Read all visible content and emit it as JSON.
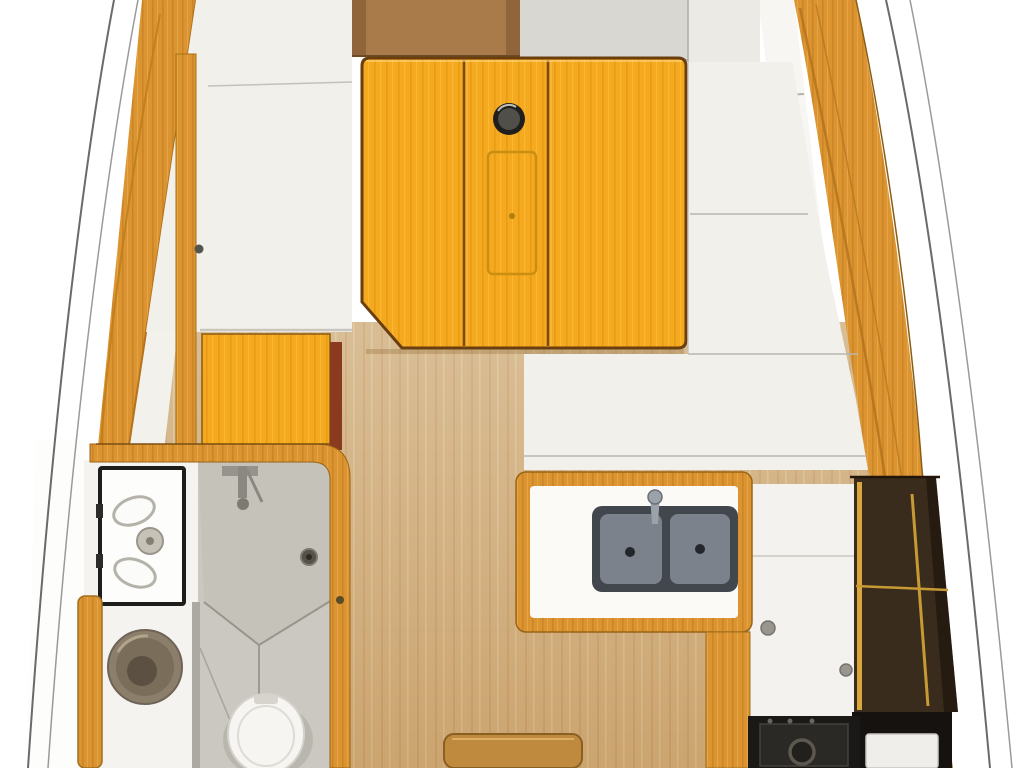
{
  "title": "sailboat-interior-floor-plan-top-view",
  "palette": {
    "hull_line": "#6a6a6a",
    "hull_line_light": "#9a9a9a",
    "trim": "#DB9430",
    "trim_dark": "#B4731C",
    "furniture": "#F4A91E",
    "furniture_grain": "#DE920E",
    "table_outline": "#6B3E0F",
    "floor": "#D2B181",
    "floor_grain": "#B98F55",
    "cushion": "#F1F0EB",
    "berth": "#D9D7D2",
    "liner": "#ECEAE5",
    "wall_white": "#F2F0EB",
    "shower": "#CBC8C1",
    "shower_tray": "#C5C2BA",
    "steel": "#7B828C",
    "steel_dark": "#42474E",
    "stove": "#1A1917",
    "shelf": "#3A2C1C",
    "shelf_rail": "#D9A73C",
    "toilet": "#F6F5F1",
    "toilet_shadow": "#B9B6AE",
    "basin": "#8B7E6B",
    "basin_deep": "#5C5042",
    "column": "#A97B4A",
    "maroon": "#8A3A1E",
    "vanity_border": "#1D1D1B",
    "step": "#C08A3E"
  },
  "areas": [
    {
      "id": "hull",
      "label": "hull outline"
    },
    {
      "id": "forward-cabin",
      "label": "forward cabin with mast column and berth"
    },
    {
      "id": "saloon-table",
      "label": "folding saloon table with bottle recess"
    },
    {
      "id": "port-settee",
      "label": "port settee"
    },
    {
      "id": "port-table",
      "label": "port side table"
    },
    {
      "id": "head",
      "label": "head (bathroom)"
    },
    {
      "id": "vanity",
      "label": "vanity washstand"
    },
    {
      "id": "round-basin",
      "label": "round washbasin"
    },
    {
      "id": "shower",
      "label": "shower tray with mixer and drain"
    },
    {
      "id": "toilet",
      "label": "toilet"
    },
    {
      "id": "cabin-sole",
      "label": "wood cabin sole / corridor"
    },
    {
      "id": "starboard-settee",
      "label": "starboard settee"
    },
    {
      "id": "galley",
      "label": "galley with double sink, lockers and stove"
    },
    {
      "id": "storage-shelves",
      "label": "starboard storage shelves"
    },
    {
      "id": "companionway-step",
      "label": "companionway step"
    }
  ]
}
